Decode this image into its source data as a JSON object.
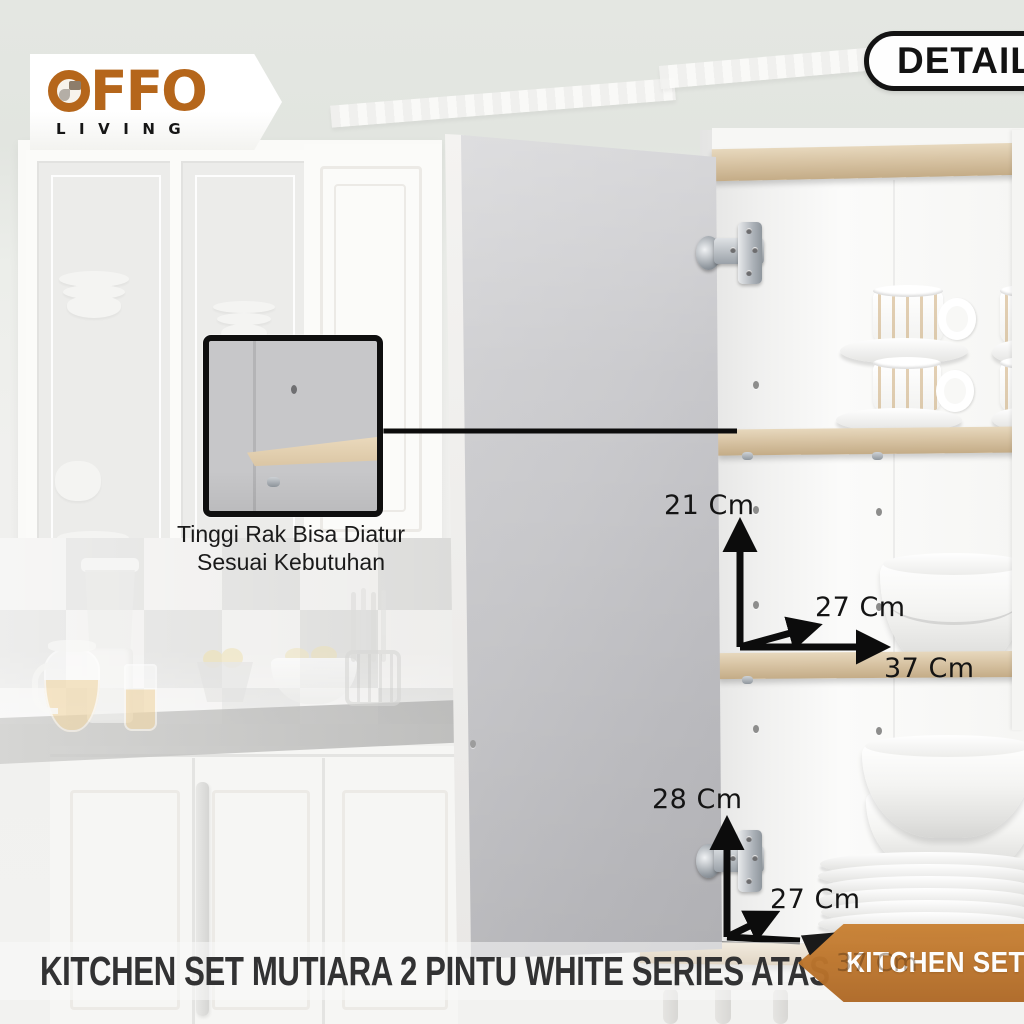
{
  "brand": {
    "name": "OFFO",
    "name_after_mark": "FFO",
    "tagline": "LIVING"
  },
  "badge": {
    "label": "DETAIL 2"
  },
  "callout": {
    "line1": "Tinggi Rak Bisa Diatur",
    "line2": "Sesuai Kebutuhan"
  },
  "dimensions": {
    "middle_shelf": {
      "height": "21 Cm",
      "depth": "27 Cm",
      "width": "37 Cm"
    },
    "bottom_compartment": {
      "height": "28 Cm",
      "depth": "27 Cm",
      "width_ghost": "37 Cm"
    }
  },
  "caption": {
    "title": "KITCHEN SET MUTIARA 2 PINTU WHITE SERIES ATAS"
  },
  "ribbon": {
    "label": "KITCHEN SET"
  },
  "colors": {
    "accent_orange": "#b5661b",
    "ribbon_orange": "#bf7a33",
    "annotation_black": "#141414",
    "wood": "#d8c4a4",
    "wall_green": "#e3e6e1"
  }
}
